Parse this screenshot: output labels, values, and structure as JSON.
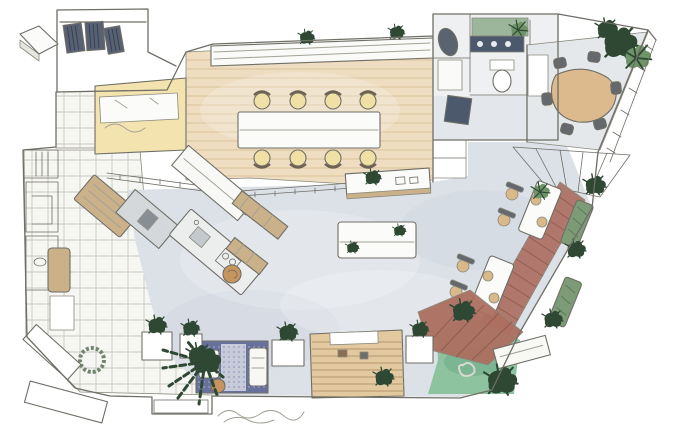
{
  "scene": {
    "type": "hand_drawn_floor_plan",
    "style": "pencil and watercolor interior sketch, top-down plan view",
    "areas": [
      "entry-vestibule",
      "wardrobe-lockers",
      "conference-area",
      "desk-nook",
      "restroom-block",
      "meeting-room",
      "open-floor",
      "kitchen-island-area",
      "dining-banquette-area",
      "pergola-frame",
      "garden-turf-corner",
      "lounge-nook",
      "tiered-seating-steps",
      "tiled-terrace"
    ]
  },
  "palette": {
    "paper": "#ffffff",
    "pencil": "#6f6e66",
    "floor_gray": "#dce1e7",
    "floor_wash": "#c7cfd9",
    "tile_floor": "#f6f6f2",
    "wood_conference": "#eeddc0",
    "desk_yellow": "#f3e3ae",
    "wood_bench": "#cbb18a",
    "wood_steps": "#e2c9a0",
    "wood_red": "#b0786c",
    "wood_red_tiles": "#ac6f60",
    "wood_table_meeting": "#dcba8e",
    "turf_green": "#8dc49f",
    "turf_shade": "#5f9c78",
    "plant_dark": "#2e4833",
    "plant_light": "#6f9468",
    "banquette_green": "#7d9b76",
    "accent_green_wall": "#9cb69b",
    "rug_navy": "#68719b",
    "rug_navy_center": "#c7cbd9",
    "counter_navy": "#4c586b",
    "fixture_dark": "#5b636e",
    "locker_dark": "#586173",
    "seat_yellow": "#efe0a6",
    "seat_gray": "#65696d",
    "seat_tan": "#d9b88a",
    "stool_orange": "#c5945f",
    "table_white": "#fbfbf9",
    "island_gray": "#d4d8da",
    "shelf_white": "#fafaf8",
    "restroom_floor": "#eef0f1",
    "meeting_floor": "#e4e8ea",
    "bench_white": "#f8f8f5"
  }
}
